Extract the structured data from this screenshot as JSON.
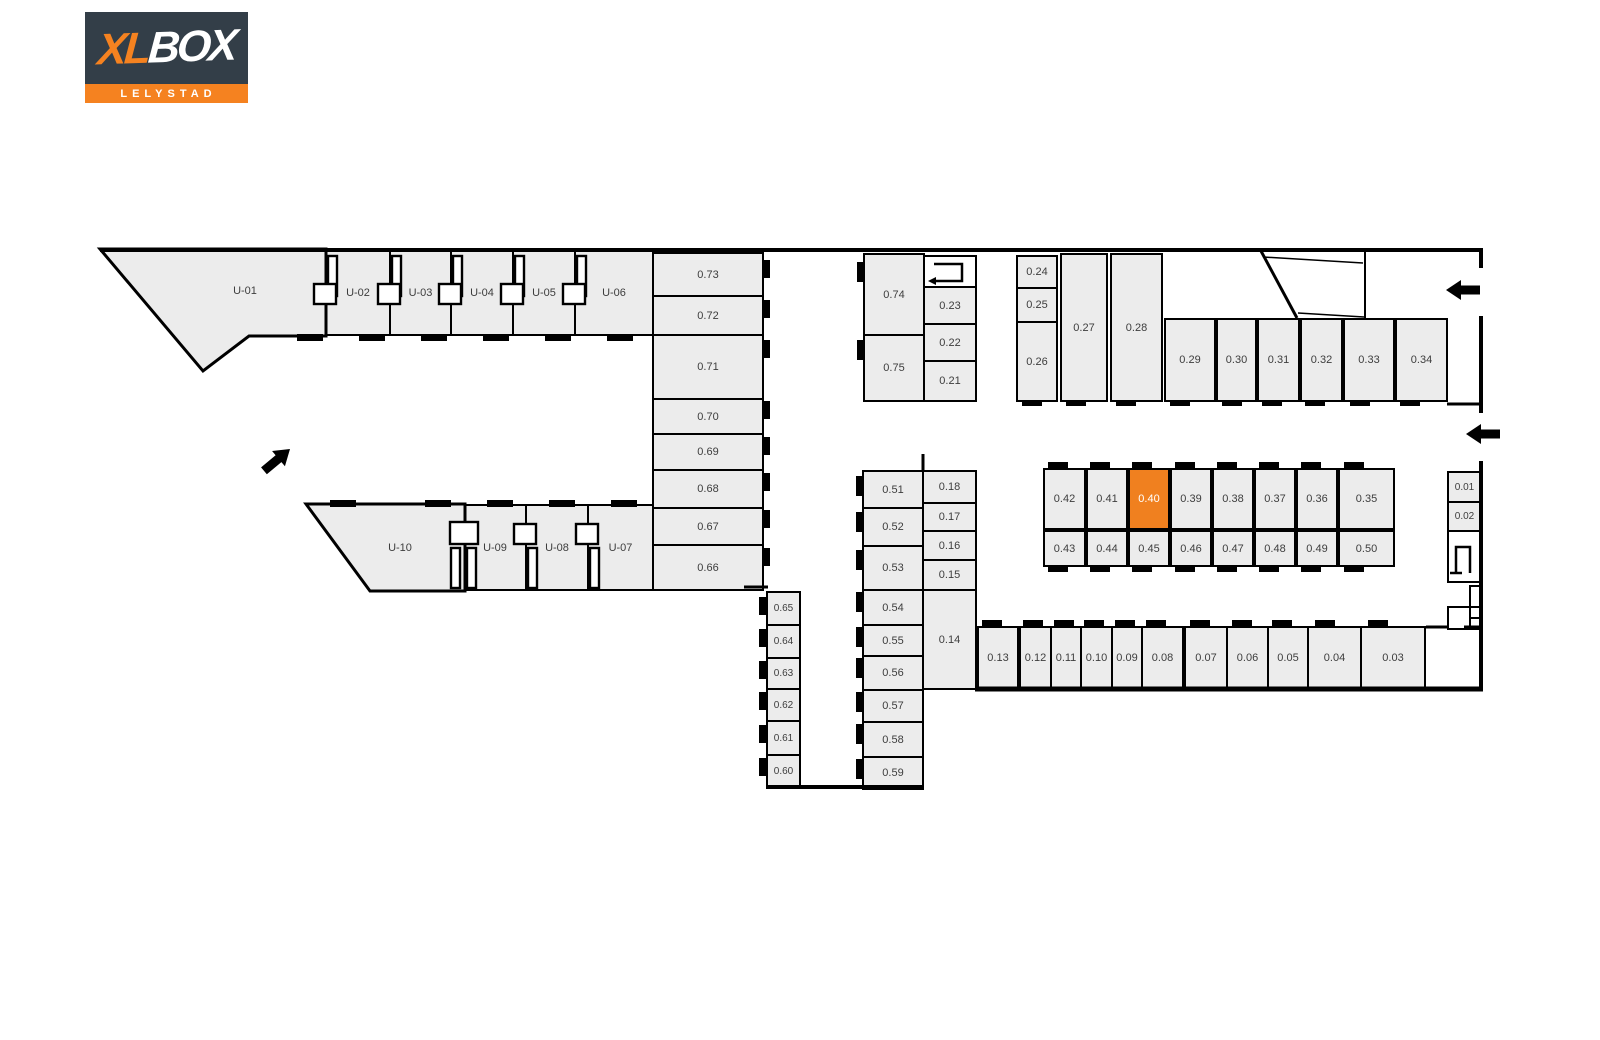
{
  "logo": {
    "xl": "XL",
    "box": "BOX",
    "subtitle": "LELYSTAD",
    "navy": "#333e48",
    "orange": "#f58220"
  },
  "colors": {
    "wall": "#000000",
    "unit_fill": "#ececec",
    "unit_text": "#3d3d3d",
    "highlight": "#f0801f",
    "highlight_text": "#ffffff",
    "background": "#ffffff"
  },
  "highlighted_unit": "0.40",
  "plan": {
    "units": [
      {
        "label": "U-02",
        "x": 325,
        "y": 250,
        "w": 66,
        "h": 86
      },
      {
        "label": "U-03",
        "x": 389,
        "y": 250,
        "w": 63,
        "h": 86
      },
      {
        "label": "U-04",
        "x": 450,
        "y": 250,
        "w": 64,
        "h": 86
      },
      {
        "label": "U-05",
        "x": 512,
        "y": 250,
        "w": 64,
        "h": 86
      },
      {
        "label": "U-06",
        "x": 574,
        "y": 250,
        "w": 80,
        "h": 86
      },
      {
        "label": "U-09",
        "x": 463,
        "y": 504,
        "w": 64,
        "h": 87
      },
      {
        "label": "U-08",
        "x": 525,
        "y": 504,
        "w": 64,
        "h": 87
      },
      {
        "label": "U-07",
        "x": 587,
        "y": 504,
        "w": 67,
        "h": 87
      },
      {
        "label": "0.73",
        "x": 652,
        "y": 252,
        "w": 112,
        "h": 45
      },
      {
        "label": "0.72",
        "x": 652,
        "y": 295,
        "w": 112,
        "h": 41
      },
      {
        "label": "0.71",
        "x": 652,
        "y": 334,
        "w": 112,
        "h": 66
      },
      {
        "label": "0.70",
        "x": 652,
        "y": 398,
        "w": 112,
        "h": 37
      },
      {
        "label": "0.69",
        "x": 652,
        "y": 433,
        "w": 112,
        "h": 38
      },
      {
        "label": "0.68",
        "x": 652,
        "y": 469,
        "w": 112,
        "h": 40
      },
      {
        "label": "0.67",
        "x": 652,
        "y": 507,
        "w": 112,
        "h": 39
      },
      {
        "label": "0.66",
        "x": 652,
        "y": 544,
        "w": 112,
        "h": 47
      },
      {
        "label": "0.65",
        "x": 766,
        "y": 591,
        "w": 35,
        "h": 35,
        "fs": 10
      },
      {
        "label": "0.64",
        "x": 766,
        "y": 624,
        "w": 35,
        "h": 35,
        "fs": 10
      },
      {
        "label": "0.63",
        "x": 766,
        "y": 657,
        "w": 35,
        "h": 33,
        "fs": 10
      },
      {
        "label": "0.62",
        "x": 766,
        "y": 688,
        "w": 35,
        "h": 34,
        "fs": 10
      },
      {
        "label": "0.61",
        "x": 766,
        "y": 720,
        "w": 35,
        "h": 36,
        "fs": 10
      },
      {
        "label": "0.60",
        "x": 766,
        "y": 754,
        "w": 35,
        "h": 35,
        "fs": 10
      },
      {
        "label": "0.51",
        "x": 862,
        "y": 470,
        "w": 62,
        "h": 39
      },
      {
        "label": "0.52",
        "x": 862,
        "y": 507,
        "w": 62,
        "h": 40
      },
      {
        "label": "0.53",
        "x": 862,
        "y": 545,
        "w": 62,
        "h": 46
      },
      {
        "label": "0.54",
        "x": 862,
        "y": 589,
        "w": 62,
        "h": 37
      },
      {
        "label": "0.55",
        "x": 862,
        "y": 624,
        "w": 62,
        "h": 33
      },
      {
        "label": "0.56",
        "x": 862,
        "y": 655,
        "w": 62,
        "h": 36
      },
      {
        "label": "0.57",
        "x": 862,
        "y": 689,
        "w": 62,
        "h": 34
      },
      {
        "label": "0.58",
        "x": 862,
        "y": 721,
        "w": 62,
        "h": 37
      },
      {
        "label": "0.59",
        "x": 862,
        "y": 756,
        "w": 62,
        "h": 34
      },
      {
        "label": "0.18",
        "x": 922,
        "y": 470,
        "w": 55,
        "h": 34
      },
      {
        "label": "0.17",
        "x": 922,
        "y": 502,
        "w": 55,
        "h": 30
      },
      {
        "label": "0.16",
        "x": 922,
        "y": 530,
        "w": 55,
        "h": 31
      },
      {
        "label": "0.15",
        "x": 922,
        "y": 559,
        "w": 55,
        "h": 32
      },
      {
        "label": "0.14",
        "x": 922,
        "y": 589,
        "w": 55,
        "h": 101
      },
      {
        "label": "0.74",
        "x": 863,
        "y": 253,
        "w": 62,
        "h": 83
      },
      {
        "label": "0.75",
        "x": 863,
        "y": 334,
        "w": 62,
        "h": 68
      },
      {
        "label": "0.23",
        "x": 923,
        "y": 286,
        "w": 54,
        "h": 39
      },
      {
        "label": "0.22",
        "x": 923,
        "y": 323,
        "w": 54,
        "h": 39
      },
      {
        "label": "0.21",
        "x": 923,
        "y": 360,
        "w": 54,
        "h": 42
      },
      {
        "label": "0.24",
        "x": 1016,
        "y": 255,
        "w": 42,
        "h": 34
      },
      {
        "label": "0.25",
        "x": 1016,
        "y": 287,
        "w": 42,
        "h": 36
      },
      {
        "label": "0.26",
        "x": 1016,
        "y": 321,
        "w": 42,
        "h": 81
      },
      {
        "label": "0.27",
        "x": 1060,
        "y": 253,
        "w": 48,
        "h": 149
      },
      {
        "label": "0.28",
        "x": 1110,
        "y": 253,
        "w": 53,
        "h": 149
      },
      {
        "label": "0.29",
        "x": 1164,
        "y": 318,
        "w": 52,
        "h": 84
      },
      {
        "label": "0.30",
        "x": 1216,
        "y": 318,
        "w": 41,
        "h": 84
      },
      {
        "label": "0.31",
        "x": 1257,
        "y": 318,
        "w": 43,
        "h": 84
      },
      {
        "label": "0.32",
        "x": 1300,
        "y": 318,
        "w": 43,
        "h": 84
      },
      {
        "label": "0.33",
        "x": 1343,
        "y": 318,
        "w": 52,
        "h": 84
      },
      {
        "label": "0.34",
        "x": 1395,
        "y": 318,
        "w": 53,
        "h": 84
      },
      {
        "label": "0.42",
        "x": 1043,
        "y": 468,
        "w": 43,
        "h": 62
      },
      {
        "label": "0.41",
        "x": 1086,
        "y": 468,
        "w": 42,
        "h": 62
      },
      {
        "label": "0.40",
        "x": 1128,
        "y": 468,
        "w": 42,
        "h": 62,
        "hl": true
      },
      {
        "label": "0.39",
        "x": 1170,
        "y": 468,
        "w": 42,
        "h": 62
      },
      {
        "label": "0.38",
        "x": 1212,
        "y": 468,
        "w": 42,
        "h": 62
      },
      {
        "label": "0.37",
        "x": 1254,
        "y": 468,
        "w": 42,
        "h": 62
      },
      {
        "label": "0.36",
        "x": 1296,
        "y": 468,
        "w": 42,
        "h": 62
      },
      {
        "label": "0.35",
        "x": 1338,
        "y": 468,
        "w": 57,
        "h": 62
      },
      {
        "label": "0.43",
        "x": 1043,
        "y": 530,
        "w": 43,
        "h": 37
      },
      {
        "label": "0.44",
        "x": 1086,
        "y": 530,
        "w": 42,
        "h": 37
      },
      {
        "label": "0.45",
        "x": 1128,
        "y": 530,
        "w": 42,
        "h": 37
      },
      {
        "label": "0.46",
        "x": 1170,
        "y": 530,
        "w": 42,
        "h": 37
      },
      {
        "label": "0.47",
        "x": 1212,
        "y": 530,
        "w": 42,
        "h": 37
      },
      {
        "label": "0.48",
        "x": 1254,
        "y": 530,
        "w": 42,
        "h": 37
      },
      {
        "label": "0.49",
        "x": 1296,
        "y": 530,
        "w": 42,
        "h": 37
      },
      {
        "label": "0.50",
        "x": 1338,
        "y": 530,
        "w": 57,
        "h": 37
      },
      {
        "label": "0.01",
        "x": 1447,
        "y": 471,
        "w": 35,
        "h": 32,
        "fs": 10
      },
      {
        "label": "0.02",
        "x": 1447,
        "y": 501,
        "w": 35,
        "h": 31,
        "fs": 10
      },
      {
        "label": "0.13",
        "x": 977,
        "y": 626,
        "w": 42,
        "h": 64
      },
      {
        "label": "0.12",
        "x": 1019,
        "y": 626,
        "w": 33,
        "h": 64
      },
      {
        "label": "0.11",
        "x": 1050,
        "y": 626,
        "w": 32,
        "h": 64
      },
      {
        "label": "0.10",
        "x": 1080,
        "y": 626,
        "w": 33,
        "h": 64
      },
      {
        "label": "0.09",
        "x": 1111,
        "y": 626,
        "w": 32,
        "h": 64
      },
      {
        "label": "0.08",
        "x": 1141,
        "y": 626,
        "w": 43,
        "h": 64
      },
      {
        "label": "0.07",
        "x": 1184,
        "y": 626,
        "w": 44,
        "h": 64
      },
      {
        "label": "0.06",
        "x": 1226,
        "y": 626,
        "w": 43,
        "h": 64
      },
      {
        "label": "0.05",
        "x": 1267,
        "y": 626,
        "w": 42,
        "h": 64
      },
      {
        "label": "0.04",
        "x": 1307,
        "y": 626,
        "w": 55,
        "h": 64
      },
      {
        "label": "0.03",
        "x": 1360,
        "y": 626,
        "w": 66,
        "h": 64
      }
    ],
    "polygons": [
      {
        "label": "U-01",
        "points": "100,249 326,249 326,336 249,336 203,371",
        "lx": 245,
        "ly": 291
      },
      {
        "label": "U-10",
        "points": "306,504 465,504 465,591 370,591",
        "lx": 400,
        "ly": 548
      }
    ],
    "white_rooms": [
      {
        "name": "stairwell-top",
        "x": 923,
        "y": 255,
        "w": 54,
        "h": 33
      },
      {
        "name": "stairwell-right",
        "x": 1447,
        "y": 530,
        "w": 35,
        "h": 53
      },
      {
        "name": "utility-a",
        "x": 1469,
        "y": 585,
        "w": 13,
        "h": 23
      },
      {
        "name": "utility-b",
        "x": 1447,
        "y": 606,
        "w": 24,
        "h": 24
      },
      {
        "name": "utility-c",
        "x": 1469,
        "y": 606,
        "w": 13,
        "h": 13
      },
      {
        "name": "utility-d",
        "x": 1469,
        "y": 617,
        "w": 13,
        "h": 13
      }
    ],
    "walls": [
      [
        100,
        250,
        1483,
        250,
        4
      ],
      [
        1481,
        250,
        1481,
        268,
        4
      ],
      [
        1481,
        316,
        1481,
        413,
        4
      ],
      [
        1481,
        461,
        1481,
        691,
        4
      ],
      [
        975,
        689,
        1483,
        689,
        5
      ],
      [
        1447,
        404,
        1483,
        404,
        3
      ],
      [
        766,
        787,
        924,
        787,
        4
      ],
      [
        744,
        587,
        768,
        587,
        3
      ],
      [
        1365,
        251,
        1365,
        319,
        2
      ],
      [
        1261,
        251,
        1297,
        318,
        3
      ],
      [
        1263,
        257,
        1363,
        263,
        1.5
      ],
      [
        1298,
        313,
        1364,
        317,
        1.5
      ],
      [
        923,
        454,
        923,
        471,
        3
      ],
      [
        1426,
        627,
        1449,
        627,
        3
      ],
      [
        1464,
        627,
        1481,
        627,
        3
      ]
    ],
    "ticks": [
      [
        297,
        334,
        26,
        7
      ],
      [
        359,
        334,
        26,
        7
      ],
      [
        421,
        334,
        26,
        7
      ],
      [
        483,
        334,
        26,
        7
      ],
      [
        545,
        334,
        26,
        7
      ],
      [
        607,
        334,
        26,
        7
      ],
      [
        330,
        500,
        26,
        7
      ],
      [
        425,
        500,
        26,
        7
      ],
      [
        487,
        500,
        26,
        7
      ],
      [
        549,
        500,
        26,
        7
      ],
      [
        611,
        500,
        26,
        7
      ],
      [
        1048,
        462,
        20,
        6
      ],
      [
        1090,
        462,
        20,
        6
      ],
      [
        1132,
        462,
        20,
        6
      ],
      [
        1175,
        462,
        20,
        6
      ],
      [
        1217,
        462,
        20,
        6
      ],
      [
        1259,
        462,
        20,
        6
      ],
      [
        1301,
        462,
        20,
        6
      ],
      [
        1344,
        462,
        20,
        6
      ],
      [
        1048,
        566,
        20,
        6
      ],
      [
        1090,
        566,
        20,
        6
      ],
      [
        1132,
        566,
        20,
        6
      ],
      [
        1175,
        566,
        20,
        6
      ],
      [
        1217,
        566,
        20,
        6
      ],
      [
        1259,
        566,
        20,
        6
      ],
      [
        1301,
        566,
        20,
        6
      ],
      [
        1344,
        566,
        20,
        6
      ],
      [
        1022,
        400,
        20,
        6
      ],
      [
        1066,
        400,
        20,
        6
      ],
      [
        1116,
        400,
        20,
        6
      ],
      [
        1170,
        400,
        20,
        6
      ],
      [
        1222,
        400,
        20,
        6
      ],
      [
        1262,
        400,
        20,
        6
      ],
      [
        1305,
        400,
        20,
        6
      ],
      [
        1350,
        400,
        20,
        6
      ],
      [
        1400,
        400,
        20,
        6
      ],
      [
        982,
        620,
        20,
        6
      ],
      [
        1023,
        620,
        20,
        6
      ],
      [
        1054,
        620,
        20,
        6
      ],
      [
        1084,
        620,
        20,
        6
      ],
      [
        1115,
        620,
        20,
        6
      ],
      [
        1146,
        620,
        20,
        6
      ],
      [
        1190,
        620,
        20,
        6
      ],
      [
        1232,
        620,
        20,
        6
      ],
      [
        1272,
        620,
        20,
        6
      ],
      [
        1315,
        620,
        20,
        6
      ],
      [
        1368,
        620,
        20,
        6
      ],
      [
        856,
        476,
        7,
        20
      ],
      [
        856,
        512,
        7,
        20
      ],
      [
        856,
        550,
        7,
        20
      ],
      [
        856,
        592,
        7,
        20
      ],
      [
        856,
        627,
        7,
        20
      ],
      [
        856,
        658,
        7,
        20
      ],
      [
        856,
        692,
        7,
        20
      ],
      [
        856,
        724,
        7,
        20
      ],
      [
        856,
        759,
        7,
        20
      ],
      [
        857,
        262,
        7,
        20
      ],
      [
        857,
        340,
        7,
        20
      ],
      [
        763,
        260,
        7,
        18
      ],
      [
        763,
        300,
        7,
        18
      ],
      [
        763,
        340,
        7,
        18
      ],
      [
        763,
        401,
        7,
        18
      ],
      [
        763,
        437,
        7,
        18
      ],
      [
        763,
        473,
        7,
        18
      ],
      [
        763,
        510,
        7,
        18
      ],
      [
        763,
        548,
        7,
        18
      ],
      [
        759,
        597,
        7,
        18
      ],
      [
        759,
        629,
        7,
        18
      ],
      [
        759,
        661,
        7,
        18
      ],
      [
        759,
        692,
        7,
        18
      ],
      [
        759,
        725,
        7,
        18
      ],
      [
        759,
        758,
        7,
        18
      ]
    ],
    "doors": [
      {
        "x": 325,
        "t": "down"
      },
      {
        "x": 389,
        "t": "down"
      },
      {
        "x": 450,
        "t": "down"
      },
      {
        "x": 512,
        "t": "down"
      },
      {
        "x": 574,
        "t": "down"
      },
      {
        "x": 463,
        "t": "up2"
      },
      {
        "x": 525,
        "t": "up"
      },
      {
        "x": 587,
        "t": "up"
      }
    ],
    "arrows": [
      {
        "x": 1446,
        "y": 290,
        "r": 0
      },
      {
        "x": 1466,
        "y": 434,
        "r": 0
      },
      {
        "x": 290,
        "y": 449,
        "r": 140
      }
    ],
    "stairs": [
      {
        "polyline": "934,264 962,264 962,281 935,281",
        "head": "936,277 936,285 928,281"
      },
      {
        "polyline": "1456,573 1456,547 1470,547 1470,573",
        "foot": [
          1450,
          573,
          1462,
          573
        ]
      }
    ]
  }
}
